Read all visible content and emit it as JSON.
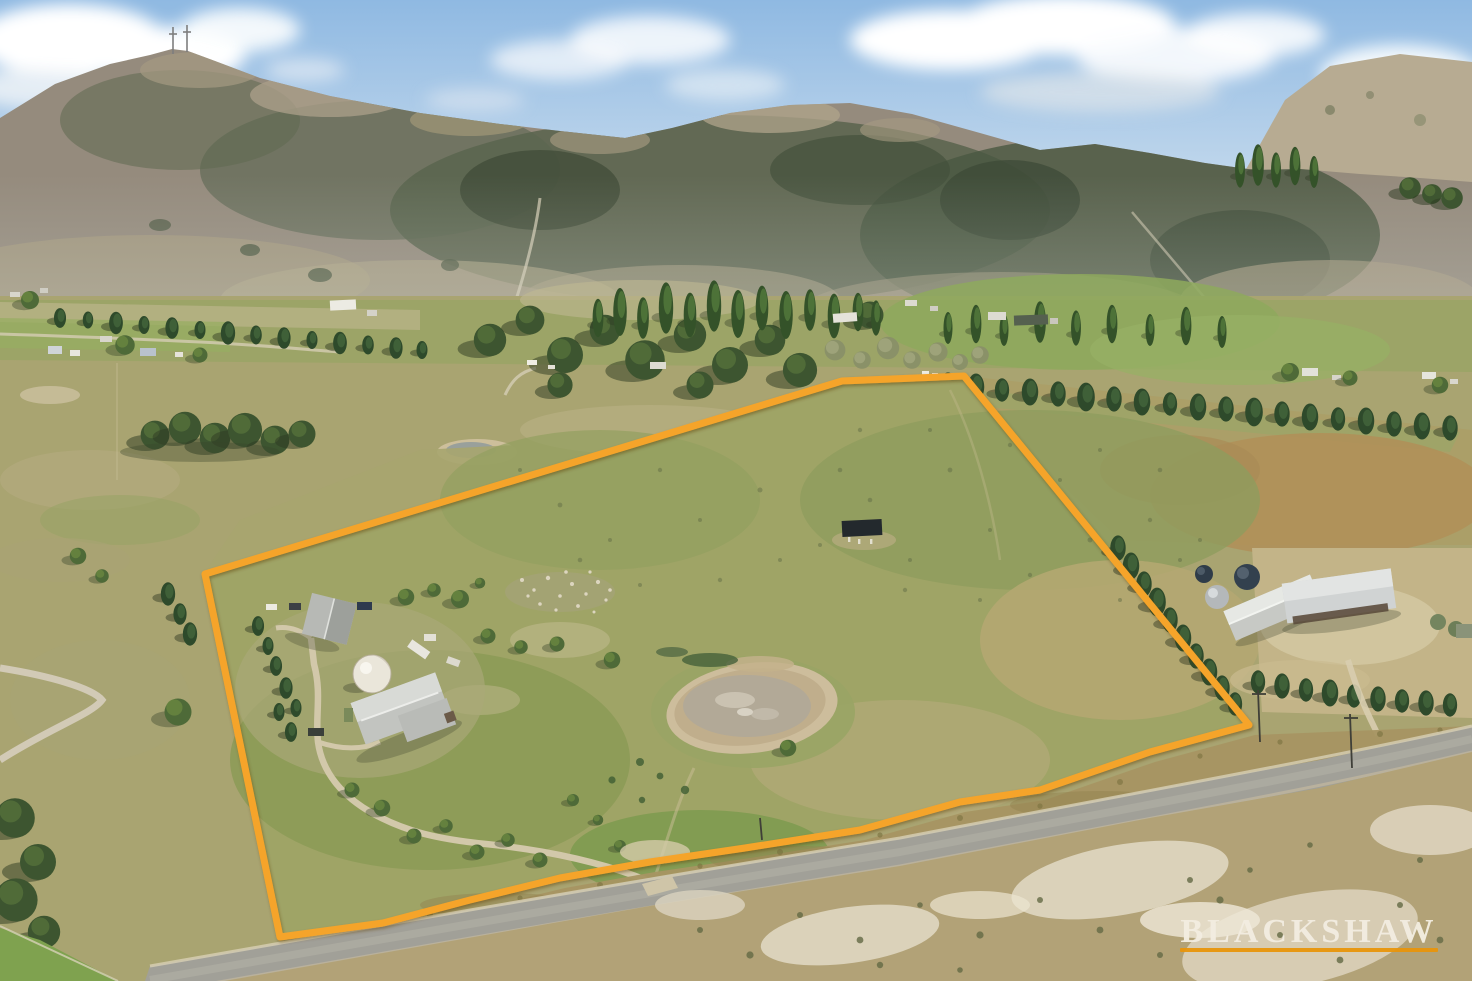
{
  "image_type": "aerial-property-photograph",
  "watermark": {
    "text": "BLACKSHAW",
    "text_color": "#f3ede1",
    "underline_color": "#e8950c"
  },
  "property_boundary": {
    "stroke_color": "#f5a42a",
    "stroke_width": 7,
    "points": "205,574 842,381 964,376 1249,725 1150,752 1040,790 960,802 860,830 745,848 650,862 560,878 470,900 383,923 280,937"
  },
  "scene": {
    "description": "Aerial drone photo of a rural acreage outlined in orange: homestead with grey roofs, white water tank, farm dam, tree windbreaks, neighbouring farm buildings, a country road, dry paddocks and a wooded mountain range with radio masts under a partly cloudy sky.",
    "sky_color": "#9fc2e4",
    "features": [
      "mountain ridge with radio masts",
      "valley farms and poplar windbreaks",
      "orange property boundary",
      "homestead and sheds",
      "white water tank",
      "farm dam",
      "conifer hedgerows",
      "country road",
      "sandy roadside scrub",
      "BLACKSHAW watermark"
    ]
  }
}
